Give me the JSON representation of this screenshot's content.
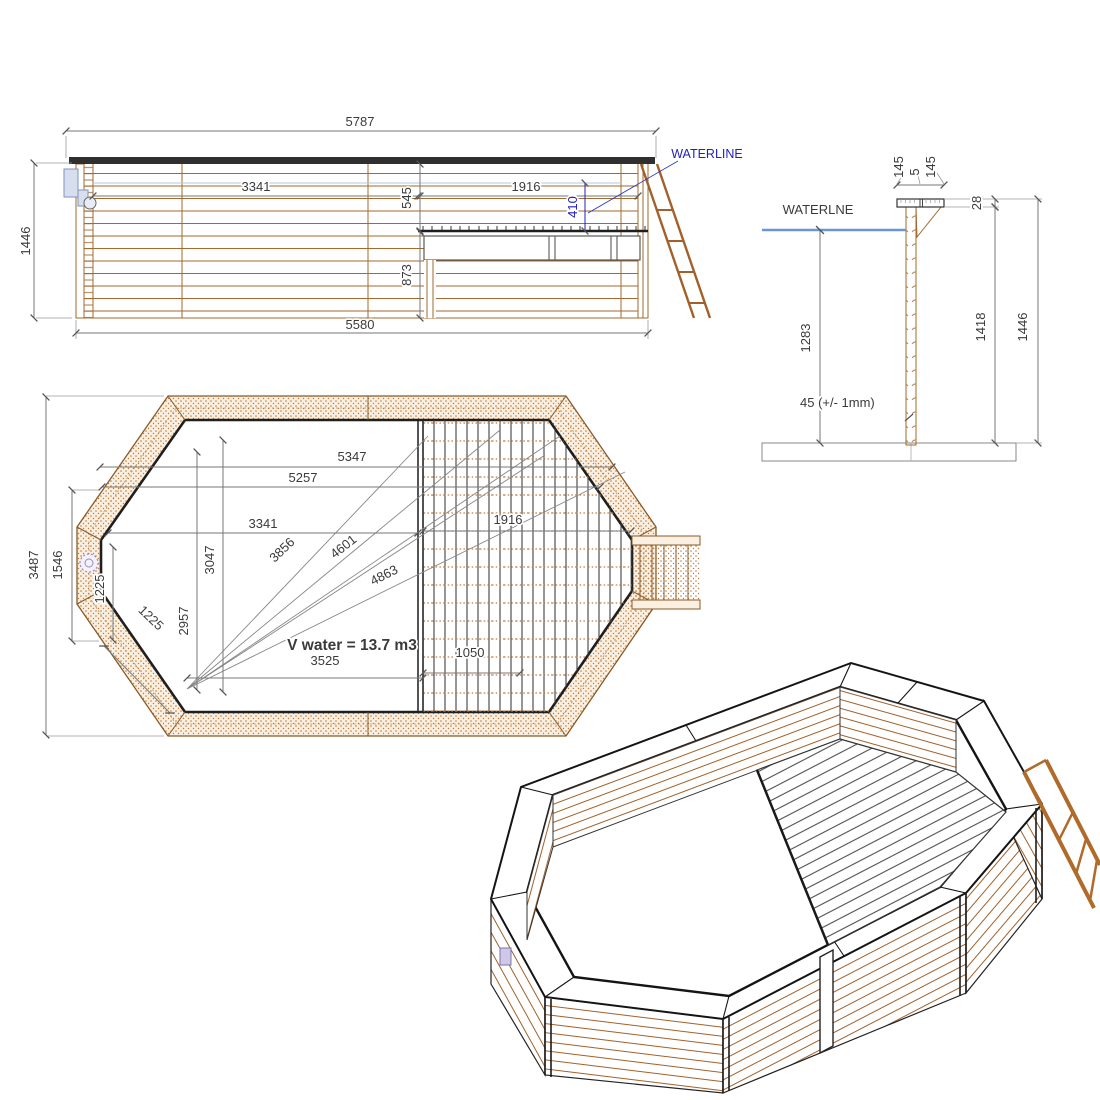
{
  "drawing_type": "wooden-pool-technical-drawing",
  "colors": {
    "wood_line": "#a26a2e",
    "wood_fill": "#f9f0e1",
    "wood_hatch": "#c07a40",
    "dim_line": "#777777",
    "text": "#3a3a3a",
    "accent_blue": "#2222bb",
    "waterline_blue": "#6b96d6",
    "dark_edge": "#232323"
  },
  "elevation": {
    "dim_overall_width": "5787",
    "dim_overall_height": "1446",
    "dim_left_section": "3341",
    "dim_top_to_deck": "545",
    "dim_deck_section": "1916",
    "dim_waterline_to_deck": "410",
    "dim_deck_to_floor": "873",
    "dim_base_width": "5580",
    "waterline_label": "WATERLINE"
  },
  "section": {
    "waterline_label": "WATERLNE",
    "dim_cap_board_a": "145",
    "dim_cap_gap": "5",
    "dim_cap_board_b": "145",
    "dim_cap_thickness": "28",
    "dim_waterline_height": "1283",
    "dim_wall_height": "1418",
    "dim_overall_height": "1446",
    "dim_plank_thickness": "45 (+/- 1mm)"
  },
  "plan": {
    "dim_overall_width_diag": "5347",
    "dim_inner_width_diag": "5257",
    "dim_left_width": "3341",
    "dim_deck_width": "1916",
    "dim_diag_a": "3856",
    "dim_diag_b": "4601",
    "dim_diag_c": "4863",
    "dim_vert_a": "3047",
    "dim_vert_b": "2957",
    "dim_corner_a": "1225",
    "dim_corner_b": "1225",
    "dim_overall_height": "3487",
    "dim_side_height": "1546",
    "dim_deck_board": "1050",
    "dim_floor_width": "3525",
    "volume_label": "V water = 13.7 m3"
  }
}
